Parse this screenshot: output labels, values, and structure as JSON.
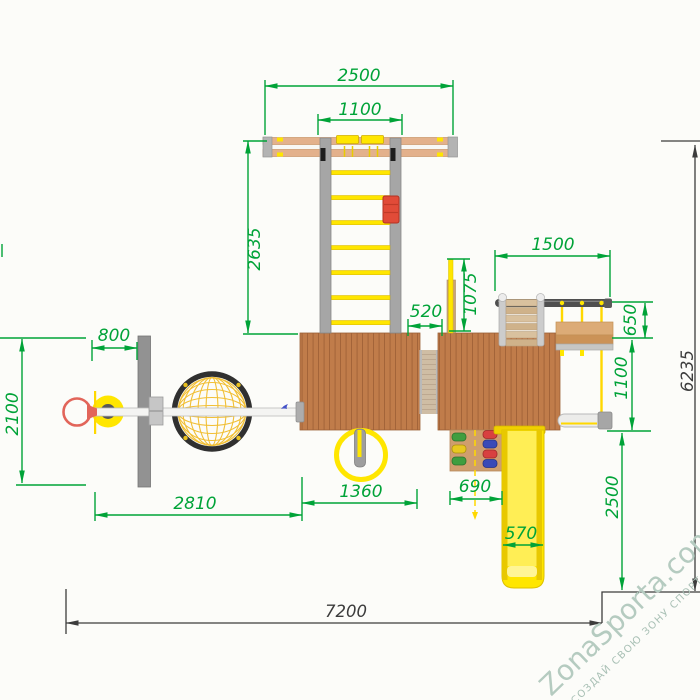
{
  "dims": {
    "beam_span": "2500",
    "ladder_span": "1100",
    "ladder_length": "2635",
    "swing_span": "1500",
    "pole_offset": "1075",
    "bridge_gap": "520",
    "swing_depth": "650",
    "hoop_offset": "800",
    "board_length": "2100",
    "frame_depth": "1100",
    "arm_span": "2810",
    "platform_span": "1360",
    "wall_span": "690",
    "slide_run": "2500",
    "slide_width": "570",
    "total_width": "7200",
    "total_depth": "6235"
  },
  "watermark": {
    "brand": "ZonaSporta.com",
    "tagline": "СОЗДАЙ СВОЮ ЗОНУ СПОРТА"
  },
  "colors": {
    "dim_green": "#00a338",
    "dim_black": "#3c3c3c",
    "wood": "#c07c4a",
    "wood_line": "#9e5f36",
    "deck": "#cfbda4",
    "deck_line": "#b7a289",
    "beam_wood": "#e3b18c",
    "yellow": "#ffe600",
    "rope_yellow": "#ffd800",
    "steel_gray": "#a6a6a6",
    "dark_beam": "#4f4f4f",
    "red": "#e2655a",
    "plate_red": "#e14b38",
    "web_black": "#303030",
    "web_yellow": "#f1bf35",
    "watermark": "#b5cbc0",
    "watermark_sub": "#a9c0b5"
  }
}
